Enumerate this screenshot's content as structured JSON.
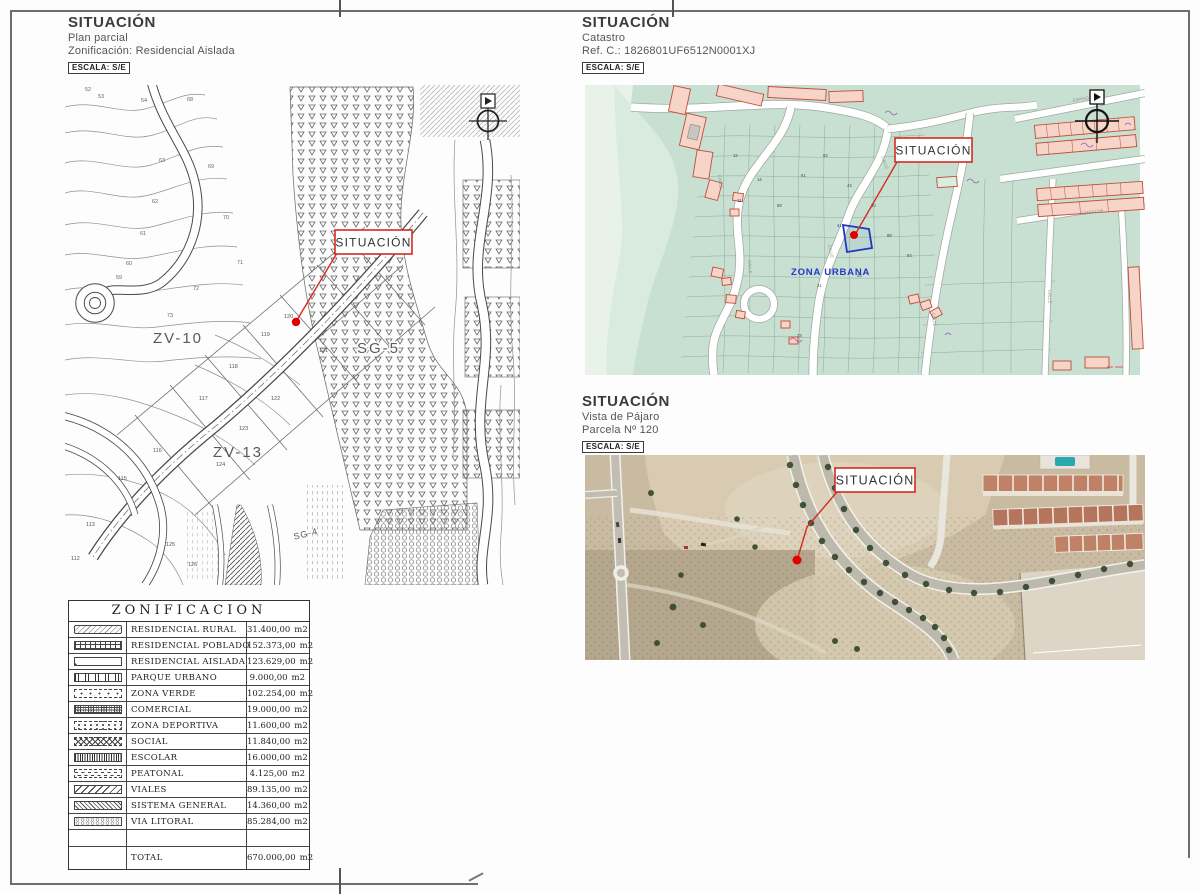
{
  "headers": {
    "plan": {
      "title": "SITUACIÓN",
      "line1": "Plan parcial",
      "line2": "Zonificación: Residencial Aislada",
      "escala": "ESCALA: S/E"
    },
    "catastro": {
      "title": "SITUACIÓN",
      "line1": "Catastro",
      "line2": "Ref. C.: 1826801UF6512N0001XJ",
      "escala": "ESCALA: S/E"
    },
    "aerial": {
      "title": "SITUACIÓN",
      "line1": "Vista de Pájaro",
      "line2": "Parcela Nº 120",
      "escala": "ESCALA: S/E"
    }
  },
  "plan_map": {
    "callout": "SITUACIÓN",
    "zone_labels": {
      "zv10": "ZV-10",
      "zv13": "ZV-13",
      "sg5": "SG-5",
      "sg4": "SG-4"
    },
    "contour_numbers": [
      "52",
      "53",
      "54",
      "68",
      "63",
      "69",
      "62",
      "70",
      "61",
      "71",
      "60",
      "59",
      "72",
      "73"
    ],
    "parcel_numbers": [
      "119",
      "121",
      "118",
      "117",
      "122",
      "116",
      "123",
      "124",
      "120",
      "115",
      "113",
      "112",
      "125",
      "126"
    ]
  },
  "catastro_map": {
    "callout": "SITUACIÓN",
    "zona_urbana": "ZONA URBANA",
    "street_label": "CALLE",
    "street_names": {
      "espino": "ESPINO",
      "azabache": "AZABACHE"
    },
    "parcel_numbers": [
      "12",
      "14",
      "11",
      "58",
      "61",
      "62",
      "44",
      "30",
      "41",
      "88",
      "84",
      "24",
      "21",
      "23"
    ]
  },
  "aerial_map": {
    "callout": "SITUACIÓN"
  },
  "table": {
    "title": "ZONIFICACION",
    "rows": [
      {
        "label": "RESIDENCIAL RURAL",
        "value": "31.400,00",
        "unit": "m2",
        "pattern": "rural"
      },
      {
        "label": "RESIDENCIAL POBLADO",
        "value": "152.373,00",
        "unit": "m2",
        "pattern": "poblado"
      },
      {
        "label": "RESIDENCIAL AISLADA",
        "value": "123.629,00",
        "unit": "m2",
        "pattern": "aislada"
      },
      {
        "label": "PARQUE URBANO",
        "value": "9.000,00",
        "unit": "m2",
        "pattern": "parque"
      },
      {
        "label": "ZONA VERDE",
        "value": "102.254,00",
        "unit": "m2",
        "pattern": "verde"
      },
      {
        "label": "COMERCIAL",
        "value": "19.000,00",
        "unit": "m2",
        "pattern": "comercial"
      },
      {
        "label": "ZONA DEPORTIVA",
        "value": "11.600,00",
        "unit": "m2",
        "pattern": "deportiva"
      },
      {
        "label": "SOCIAL",
        "value": "11.840,00",
        "unit": "m2",
        "pattern": "social"
      },
      {
        "label": "ESCOLAR",
        "value": "16.000,00",
        "unit": "m2",
        "pattern": "escolar"
      },
      {
        "label": "PEATONAL",
        "value": "4.125,00",
        "unit": "m2",
        "pattern": "peatonal"
      },
      {
        "label": "VIALES",
        "value": "89.135,00",
        "unit": "m2",
        "pattern": "viales"
      },
      {
        "label": "SISTEMA GENERAL",
        "value": "14.360,00",
        "unit": "m2",
        "pattern": "sistema"
      },
      {
        "label": "VIA LITORAL",
        "value": "85.284,00",
        "unit": "m2",
        "pattern": "litoral"
      },
      {
        "label": "TOTAL",
        "value": "670.000,00",
        "unit": "m2"
      }
    ]
  },
  "colors": {
    "callout_red": "#d42a20",
    "marker_red": "#e10000",
    "cadastre_green": "#c7e0d2",
    "building_pink": "#f6d4c8",
    "zona_urbana_blue": "#2438c8"
  }
}
